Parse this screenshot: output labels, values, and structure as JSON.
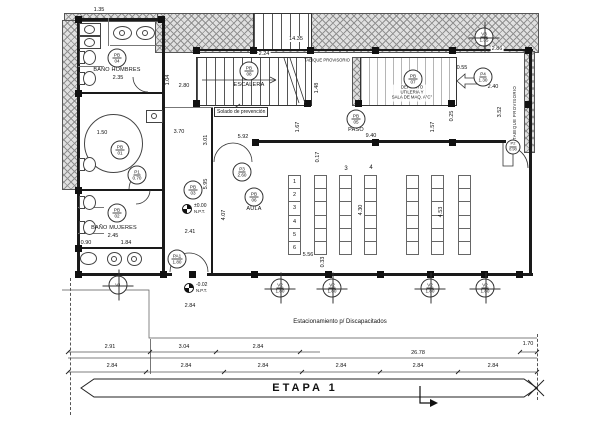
{
  "drawing": {
    "stage_label": "ETAPA 1",
    "parking_label": "Estacionamiento p/ Discapacitados",
    "solado_label": "Solado de prevención",
    "tabique_label_vertical": "TABIQUE PROVISORIO",
    "tabique_label_horizontal": "TABIQUE PROVISORIO",
    "deposito_lines": [
      "DEPOSITO",
      "UTILERIA Y",
      "SALA DE MAQ. A°C°"
    ]
  },
  "room_labels": [
    {
      "id": "bano-hombres",
      "text": "BAÑO HOMBRES",
      "x": 117,
      "y": 70
    },
    {
      "id": "bano-mujeres",
      "text": "BAÑO MUJERES",
      "x": 114,
      "y": 228
    },
    {
      "id": "aula",
      "text": "AULA",
      "x": 254,
      "y": 209
    },
    {
      "id": "paso",
      "text": "PASO",
      "x": 356,
      "y": 130
    },
    {
      "id": "escalera",
      "text": "ESCALERA",
      "x": 249,
      "y": 85
    }
  ],
  "bubbles": [
    {
      "id": "pb04",
      "l1": "PB",
      "l2": "04",
      "x": 117,
      "y": 58
    },
    {
      "id": "pb01",
      "l1": "PB",
      "l2": "01",
      "x": 120,
      "y": 150
    },
    {
      "id": "pb02",
      "l1": "PB",
      "l2": "02",
      "x": 117,
      "y": 213
    },
    {
      "id": "pb03",
      "l1": "PB",
      "l2": "03",
      "x": 193,
      "y": 190
    },
    {
      "id": "pb05",
      "l1": "PB",
      "l2": "05",
      "x": 356,
      "y": 119
    },
    {
      "id": "pb06",
      "l1": "PB",
      "l2": "06",
      "x": 254,
      "y": 197
    },
    {
      "id": "pb07",
      "l1": "PB",
      "l2": "07",
      "x": 413,
      "y": 79
    },
    {
      "id": "pb08",
      "l1": "PB",
      "l2": "08",
      "x": 249,
      "y": 71
    },
    {
      "id": "p1",
      "l1": "P1",
      "l2": "0.70",
      "x": 137,
      "y": 175
    },
    {
      "id": "p2",
      "l1": "P2",
      "l2": "0.90",
      "x": 513,
      "y": 147,
      "small": true
    },
    {
      "id": "p3",
      "l1": "P3",
      "l2": "2.60",
      "x": 242,
      "y": 172
    },
    {
      "id": "p4",
      "l1": "P4",
      "l2": "1.30",
      "x": 483,
      "y": 77
    },
    {
      "id": "pa1",
      "l1": "PA1",
      "l2": "1.80",
      "x": 177,
      "y": 259
    },
    {
      "id": "v1",
      "l1": "V1",
      "l2": "",
      "x": 118,
      "y": 285,
      "cross": true
    },
    {
      "id": "v2-1",
      "l1": "V2",
      "l2": "1.80",
      "x": 280,
      "y": 288,
      "cross": true
    },
    {
      "id": "v2-2",
      "l1": "V2",
      "l2": "1.80",
      "x": 332,
      "y": 288,
      "cross": true
    },
    {
      "id": "v2-3",
      "l1": "V2",
      "l2": "1.80",
      "x": 430,
      "y": 288,
      "cross": true
    },
    {
      "id": "v2-4",
      "l1": "V2",
      "l2": "1.80",
      "x": 485,
      "y": 288,
      "cross": true
    },
    {
      "id": "v3",
      "l1": "V3",
      "l2": "1.35",
      "x": 484,
      "y": 37,
      "cross": true
    }
  ],
  "desk_rows": [
    "1",
    "2",
    "3",
    "4",
    "5",
    "6"
  ],
  "desk_group_labels": [
    {
      "text": "3",
      "x": 346,
      "y": 169
    },
    {
      "text": "4",
      "x": 371,
      "y": 168
    }
  ],
  "levels": [
    {
      "id": "level-pb",
      "text": "±0.00",
      "sub": "N.P.T.",
      "x": 182,
      "y": 204
    },
    {
      "id": "level-ext",
      "text": "-0.02",
      "sub": "N.P.T.",
      "x": 184,
      "y": 283
    }
  ],
  "dims": [
    {
      "t": "1.35",
      "x": 99,
      "y": 10,
      "bg": 1
    },
    {
      "t": "14.35",
      "x": 296,
      "y": 39,
      "bg": 1
    },
    {
      "t": "2.24",
      "x": 264,
      "y": 54,
      "bg": 1
    },
    {
      "t": "2.86",
      "x": 497,
      "y": 49,
      "bg": 1
    },
    {
      "t": "0.55",
      "x": 462,
      "y": 68
    },
    {
      "t": "2.40",
      "x": 493,
      "y": 87
    },
    {
      "t": "3.52",
      "x": 500,
      "y": 112,
      "v": 1
    },
    {
      "t": "0.25",
      "x": 452,
      "y": 116,
      "v": 1
    },
    {
      "t": "1.57",
      "x": 433,
      "y": 127,
      "v": 1
    },
    {
      "t": "1.48",
      "x": 317,
      "y": 88,
      "v": 1
    },
    {
      "t": "1.67",
      "x": 298,
      "y": 127,
      "v": 1
    },
    {
      "t": "1.04",
      "x": 168,
      "y": 80,
      "v": 1
    },
    {
      "t": "2.80",
      "x": 184,
      "y": 86
    },
    {
      "t": "2.35",
      "x": 118,
      "y": 78
    },
    {
      "t": "3.70",
      "x": 179,
      "y": 132
    },
    {
      "t": "3.01",
      "x": 206,
      "y": 140,
      "v": 1
    },
    {
      "t": "5.95",
      "x": 206,
      "y": 184,
      "v": 1
    },
    {
      "t": "4.07",
      "x": 224,
      "y": 215,
      "v": 1
    },
    {
      "t": "2.41",
      "x": 190,
      "y": 232
    },
    {
      "t": "2.45",
      "x": 113,
      "y": 236
    },
    {
      "t": "1.84",
      "x": 126,
      "y": 243
    },
    {
      "t": "0.90",
      "x": 86,
      "y": 243
    },
    {
      "t": "1.50",
      "x": 102,
      "y": 133
    },
    {
      "t": "9.40",
      "x": 371,
      "y": 136
    },
    {
      "t": "5.92",
      "x": 243,
      "y": 137
    },
    {
      "t": "0.17",
      "x": 318,
      "y": 157,
      "v": 1
    },
    {
      "t": "4.30",
      "x": 361,
      "y": 210,
      "v": 1
    },
    {
      "t": "4.53",
      "x": 441,
      "y": 212,
      "v": 1
    },
    {
      "t": "5.56",
      "x": 308,
      "y": 255
    },
    {
      "t": "0.33",
      "x": 323,
      "y": 262,
      "v": 1
    },
    {
      "t": "2.84",
      "x": 190,
      "y": 306
    },
    {
      "t": "2.91",
      "x": 110,
      "y": 347
    },
    {
      "t": "3.04",
      "x": 184,
      "y": 347
    },
    {
      "t": "2.84",
      "x": 258,
      "y": 347
    },
    {
      "t": "1.70",
      "x": 528,
      "y": 344
    },
    {
      "t": "26.78",
      "x": 418,
      "y": 353
    },
    {
      "t": "2.84",
      "x": 112,
      "y": 366
    },
    {
      "t": "2.84",
      "x": 186,
      "y": 366
    },
    {
      "t": "2.84",
      "x": 263,
      "y": 366
    },
    {
      "t": "2.84",
      "x": 341,
      "y": 366
    },
    {
      "t": "2.84",
      "x": 418,
      "y": 366
    },
    {
      "t": "2.84",
      "x": 493,
      "y": 366
    }
  ]
}
